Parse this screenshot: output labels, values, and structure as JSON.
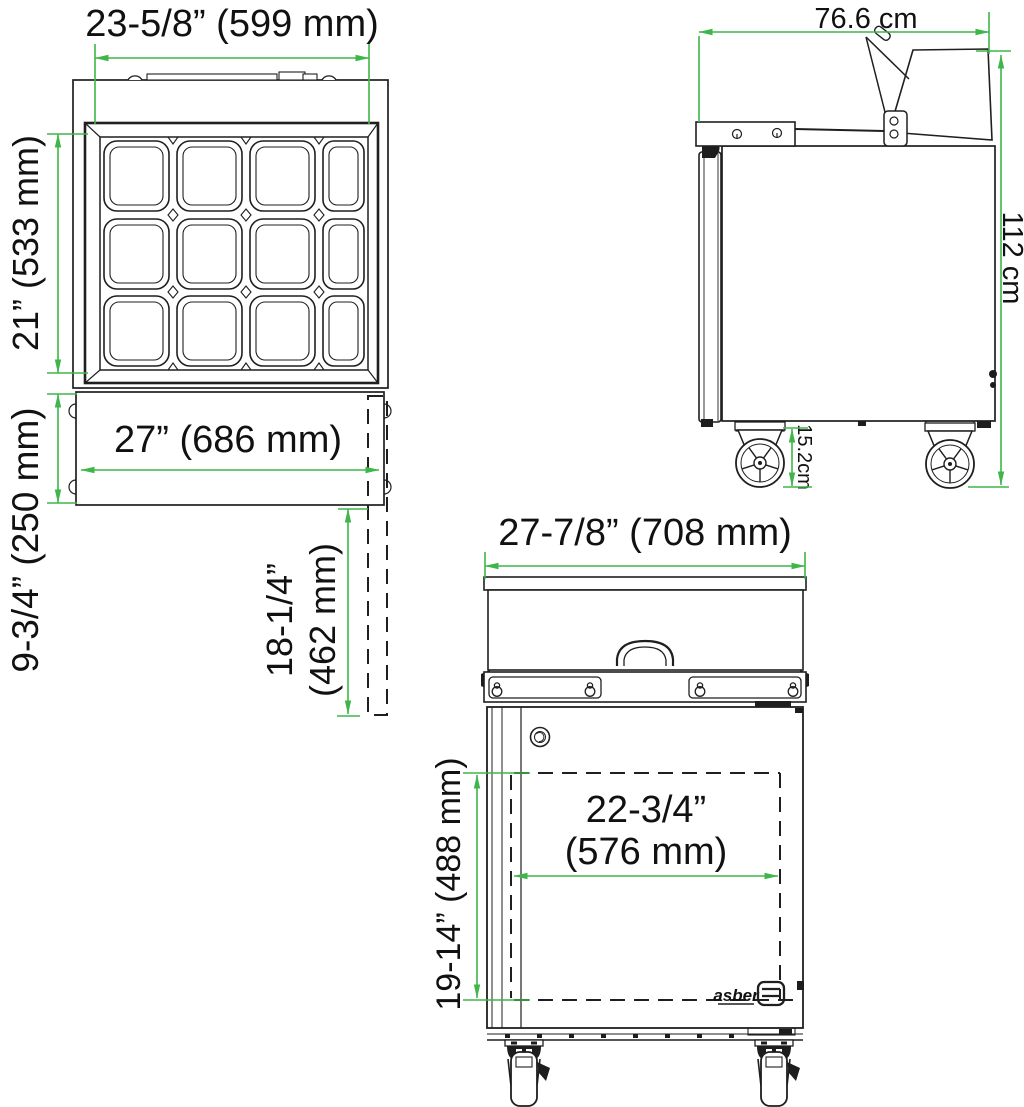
{
  "colors": {
    "line": "#1f1f1f",
    "dimension_green": "#3fb54a",
    "background": "#ffffff"
  },
  "views": {
    "top": {
      "dims": {
        "overall_width": "23-5/8” (599 mm)",
        "pan_area_depth": "21” (533 mm)",
        "body_width": "27” (686 mm)",
        "front_section_depth": "9-3/4” (250 mm)",
        "cutting_board_depth_line1": "18-1/4”",
        "cutting_board_depth_line2": "(462 mm)"
      }
    },
    "side": {
      "dims": {
        "overall_depth": "76.6 cm",
        "overall_height": "112 cm",
        "caster_height": "15.2cm"
      }
    },
    "front": {
      "dims": {
        "overall_width": "27-7/8” (708 mm)",
        "door_width_line1": "22-3/4”",
        "door_width_line2": "(576 mm)",
        "door_height": "19-14” (488 mm)"
      },
      "brand": "asber"
    }
  }
}
